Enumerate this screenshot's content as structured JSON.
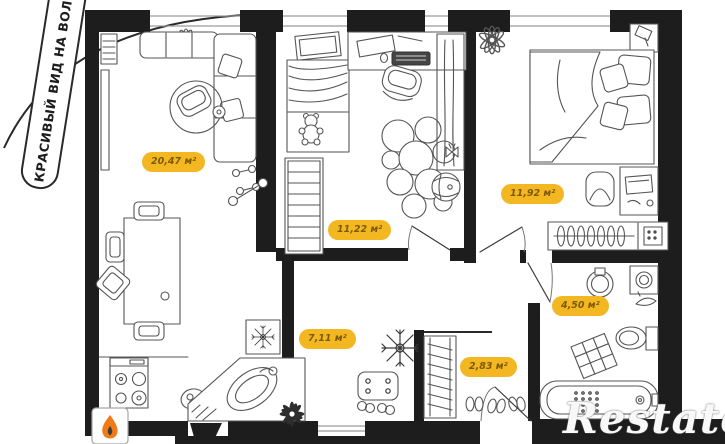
{
  "banner": {
    "text": "КРАСИВЫЙ ВИД НА ВОЛГУ"
  },
  "watermark": {
    "text": "Restate"
  },
  "rooms": {
    "living": {
      "name": "living-dining-kitchen",
      "area_label": "20,47 м²"
    },
    "kids": {
      "name": "kids-room",
      "area_label": "11,22 м²"
    },
    "bedroom": {
      "name": "bedroom",
      "area_label": "11,92 м²"
    },
    "hallway": {
      "name": "hallway",
      "area_label": "7,11 м²"
    },
    "closet": {
      "name": "wardrobe-closet",
      "area_label": "2,83 м²"
    },
    "bathroom": {
      "name": "bathroom",
      "area_label": "4,50 м²"
    }
  },
  "colors": {
    "badge_bg": "#F3B722",
    "badge_text": "#7C5A05",
    "wall": "#1D1D1D",
    "line": "#555555",
    "flame": "#F07B17"
  }
}
